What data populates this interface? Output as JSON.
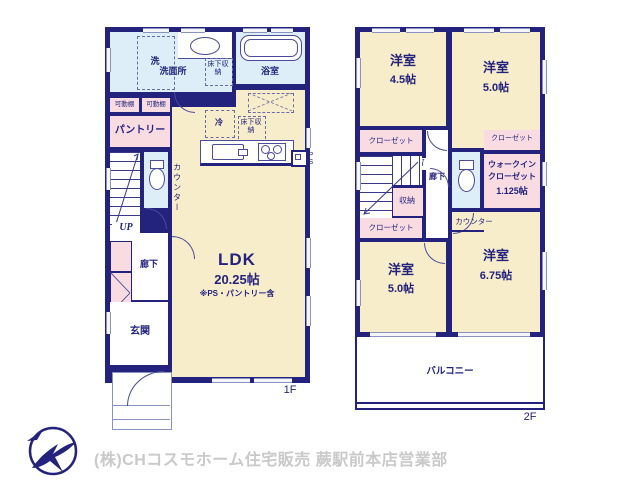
{
  "colors": {
    "wall": "#23237d",
    "room_cream": "#f8edcb",
    "closet_pink": "#f9dce2",
    "wet_blue": "#ddeef8",
    "label_text": "#23237d",
    "footer_text": "#c9c9c9"
  },
  "floor1": {
    "label": "1F",
    "washer": "洗",
    "washroom": "洗面所",
    "underfloor1": "床下収納",
    "bathroom": "浴室",
    "fridge": "冷",
    "shelf1": "可動棚",
    "shelf2": "可動棚",
    "pantry": "パントリー",
    "counter": "カウンター",
    "underfloor2": "床下収納",
    "up": "UP",
    "hallway": "廊下",
    "entrance": "玄関",
    "ldk": "LDK",
    "ldk_size": "20.25帖",
    "ldk_note": "※PS・パントリー含",
    "ps": "PS"
  },
  "floor2": {
    "label": "2F",
    "room_tl": "洋室",
    "room_tl_size": "4.5帖",
    "room_tr": "洋室",
    "room_tr_size": "5.0帖",
    "closet_tl": "クローゼット",
    "closet_tr": "クローゼット",
    "closet_bl": "クローゼット",
    "dn": "DN",
    "hallway": "廊下",
    "storage": "収納",
    "wic_line1": "ウォークイン",
    "wic_line2": "クローゼット",
    "wic_size": "1.125帖",
    "counter": "カウンター",
    "room_bl": "洋室",
    "room_bl_size": "5.0帖",
    "room_br": "洋室",
    "room_br_size": "6.75帖",
    "balcony": "バルコニー"
  },
  "footer": {
    "company": "(株)CHコスモホーム住宅販売 蕨駅前本店営業部"
  }
}
